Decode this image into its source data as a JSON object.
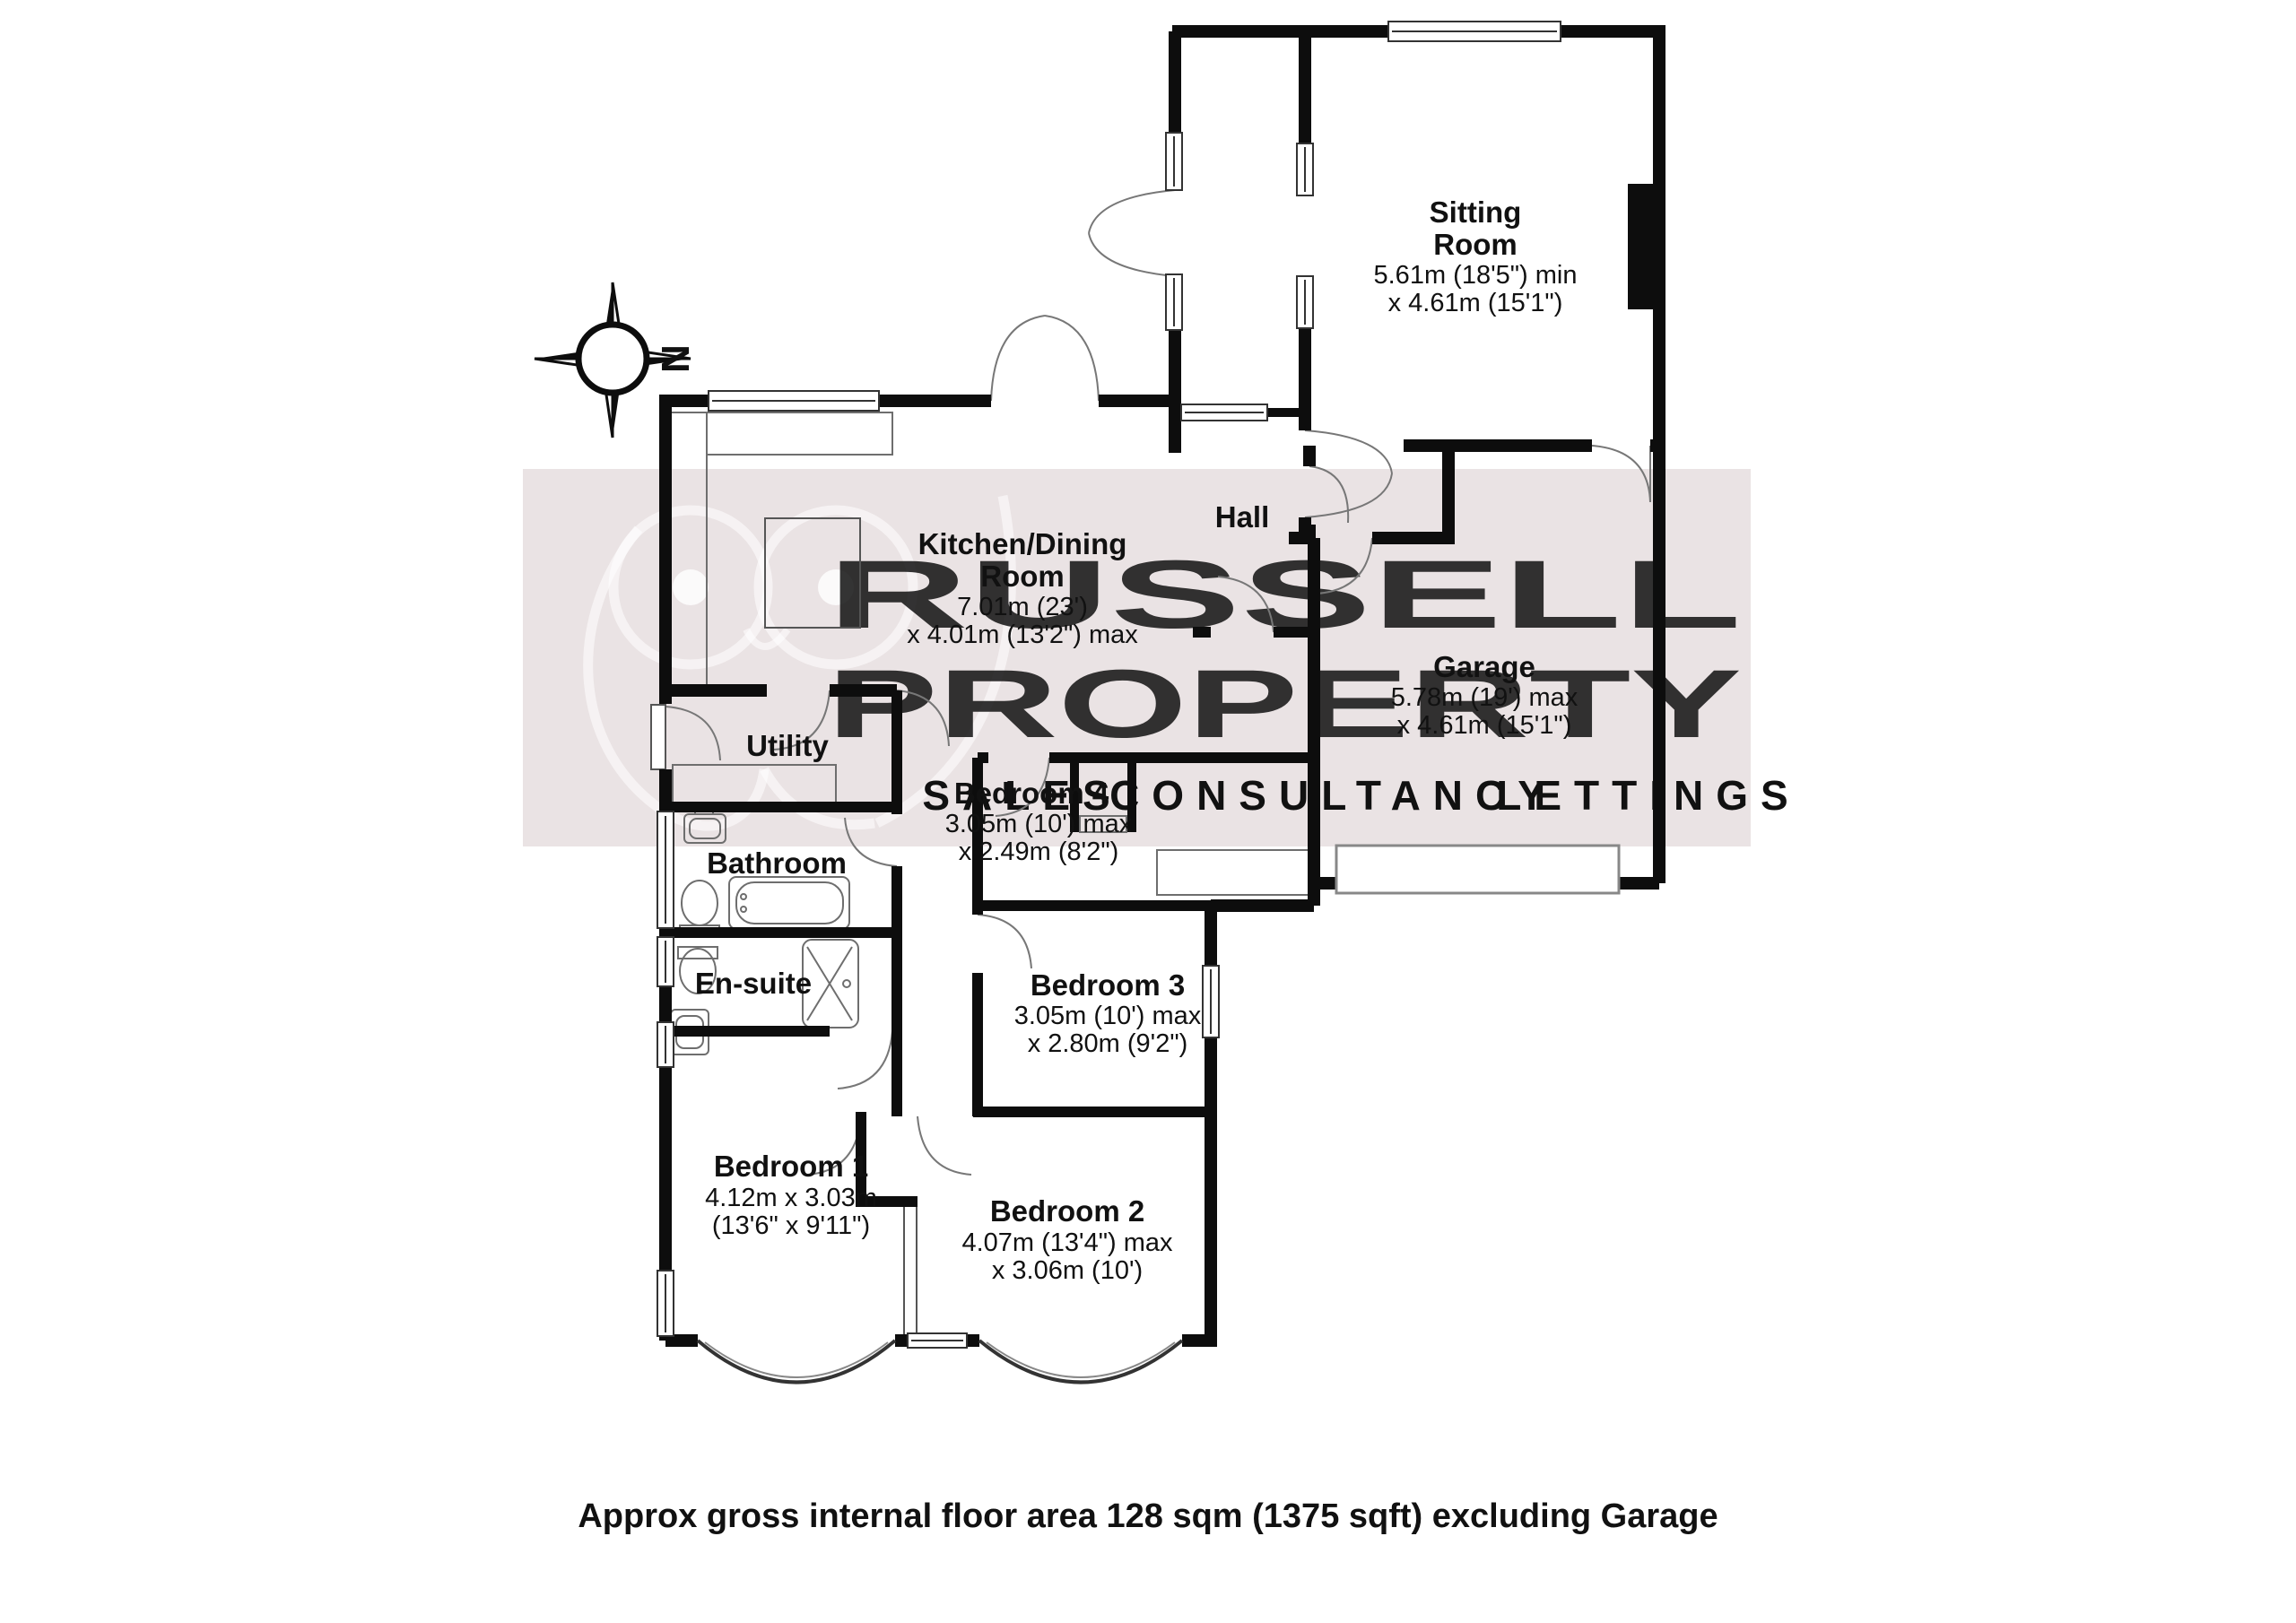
{
  "watermark": {
    "line1": "RUSSELL",
    "line2": "PROPERTY",
    "sub1": "SALES",
    "sub2": "CONSULTANCY",
    "sub3": "LETTINGS",
    "band_color": "#EAE3E4",
    "text_color": "#FFFFFF",
    "sub1_color": "#EDF3C6",
    "sub2_color": "#F6D2D1",
    "sub3_color": "#D2EDE9"
  },
  "compass": {
    "north_label": "N"
  },
  "rooms": {
    "sitting": [
      "Sitting",
      "Room",
      "5.61m (18'5\") min",
      "x 4.61m (15'1\")"
    ],
    "kitchen": [
      "Kitchen/Dining",
      "Room",
      "7.01m (23')",
      "x 4.01m (13'2\") max"
    ],
    "hall": [
      "Hall"
    ],
    "garage": [
      "Garage",
      "5.78m (19') max",
      "x 4.61m (15'1\")"
    ],
    "utility": [
      "Utility"
    ],
    "bathroom": [
      "Bathroom"
    ],
    "ensuite": [
      "En-suite"
    ],
    "bedroom1": [
      "Bedroom 1",
      "4.12m x 3.03m",
      "(13'6\" x 9'11\")"
    ],
    "bedroom2": [
      "Bedroom 2",
      "4.07m (13'4\") max",
      "x 3.06m (10')"
    ],
    "bedroom3": [
      "Bedroom 3",
      "3.05m (10') max",
      "x 2.80m (9'2\")"
    ],
    "bedroom4": [
      "Bedroom 4",
      "3.05m (10') max",
      "x 2.49m (8'2\")"
    ]
  },
  "footer": {
    "caption": "Approx gross internal floor area 128 sqm (1375 sqft) excluding Garage"
  }
}
